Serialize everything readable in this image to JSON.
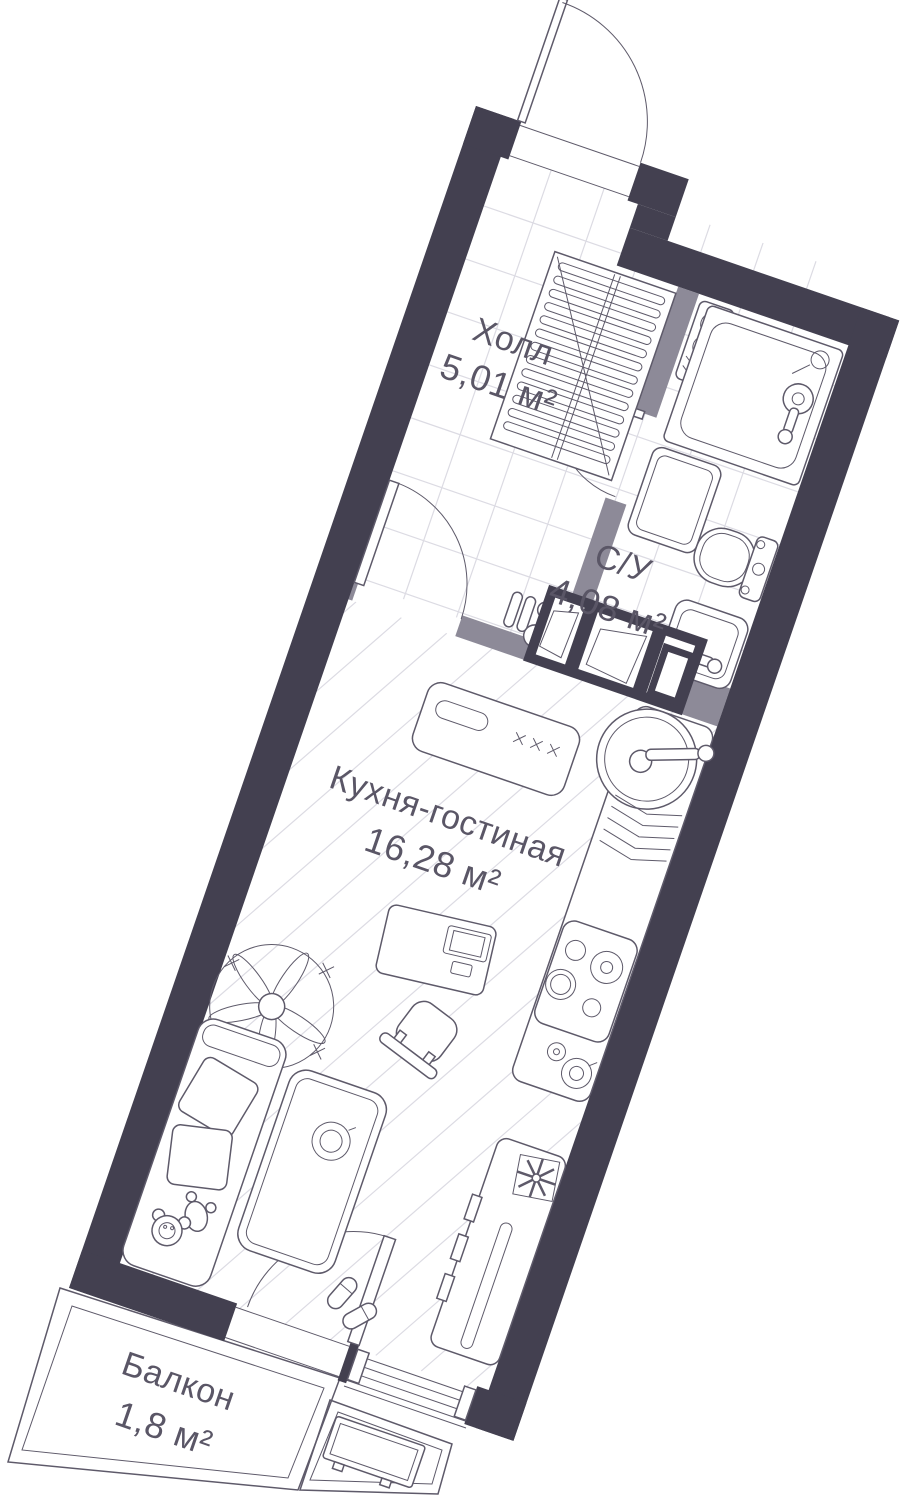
{
  "floorplan": {
    "title": "Studio apartment floor plan",
    "rooms": [
      {
        "id": "hall",
        "name": "Холл",
        "area": "5,01 м²"
      },
      {
        "id": "bathroom",
        "name": "С/У",
        "area": "4,08 м²"
      },
      {
        "id": "kitchen_living",
        "name": "Кухня-гостиная",
        "area": "16,28 м²"
      },
      {
        "id": "balcony",
        "name": "Балкон",
        "area": "1,8 м²"
      }
    ],
    "colors": {
      "wall": "#434050",
      "partition": "#8d8a98",
      "outline": "#5e5a6a",
      "floor_line": "#dcdbe3",
      "text": "#5a5666",
      "background": "#ffffff"
    },
    "fixtures": [
      "entry-door",
      "coat-rack",
      "water-heater",
      "shower",
      "washing-machine",
      "toilet",
      "washbasin",
      "pipe-risers",
      "vent-shaft",
      "kitchen-counter",
      "kitchen-sink",
      "dish-rack",
      "stove",
      "desk",
      "laptop",
      "chair",
      "plant",
      "sofa",
      "teddy-bear",
      "rug",
      "coffee-tray",
      "slippers",
      "storage-unit",
      "balcony-door",
      "window",
      "balcony-ac-unit"
    ],
    "rotation_deg": 19
  }
}
